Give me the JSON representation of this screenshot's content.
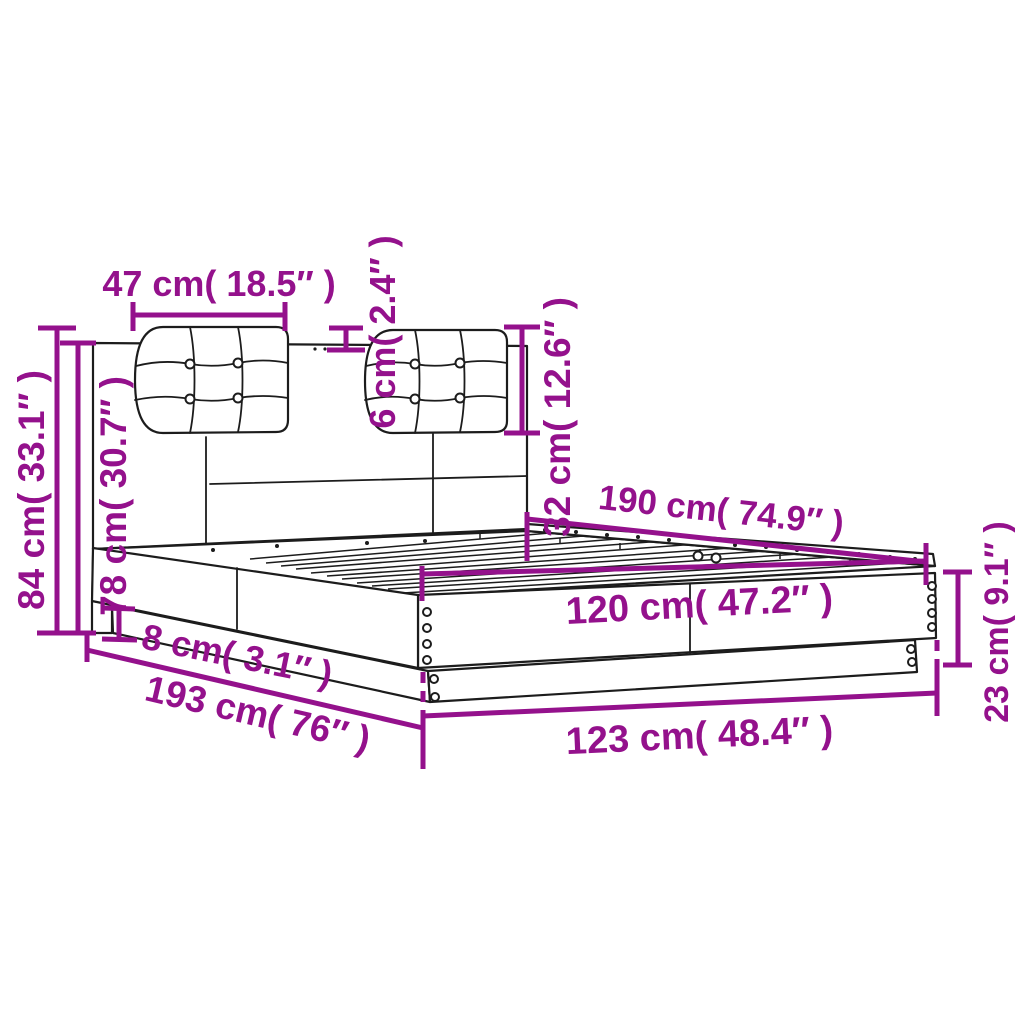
{
  "page": {
    "background": "#ffffff"
  },
  "colors": {
    "accent": "#94118C",
    "line": "#1c1c1c"
  },
  "diagram": {
    "type": "product-dimension-diagram",
    "subject": "bed-frame-with-headboard-and-two-tufted-cushions"
  },
  "dimensions": {
    "cushion_width": {
      "cm": 47,
      "inch": "18.5",
      "label": "47 cm( 18.5″ )"
    },
    "cushion_thickness": {
      "cm": 6,
      "inch": "2.4",
      "label": "6 cm( 2.4″ )"
    },
    "headboard_upper_height": {
      "cm": 32,
      "inch": "12.6",
      "label": "32 cm( 12.6″ )"
    },
    "total_height": {
      "cm": 84,
      "inch": "33.1",
      "label": "84 cm( 33.1″ )"
    },
    "headboard_height": {
      "cm": 78,
      "inch": "30.7",
      "label": "78 cm( 30.7″ )"
    },
    "plinth_height": {
      "cm": 8,
      "inch": "3.1",
      "label": "8 cm( 3.1″ )"
    },
    "outer_length": {
      "cm": 193,
      "inch": "76",
      "label": "193 cm( 76″ )"
    },
    "inner_length": {
      "cm": 190,
      "inch": "74.9",
      "label": "190 cm( 74.9″ )"
    },
    "inner_width": {
      "cm": 120,
      "inch": "47.2",
      "label": "120 cm( 47.2″ )"
    },
    "outer_width": {
      "cm": 123,
      "inch": "48.4",
      "label": "123 cm( 48.4″ )"
    },
    "frame_height": {
      "cm": 23,
      "inch": "9.1",
      "label": "23 cm( 9.1″ )"
    }
  }
}
